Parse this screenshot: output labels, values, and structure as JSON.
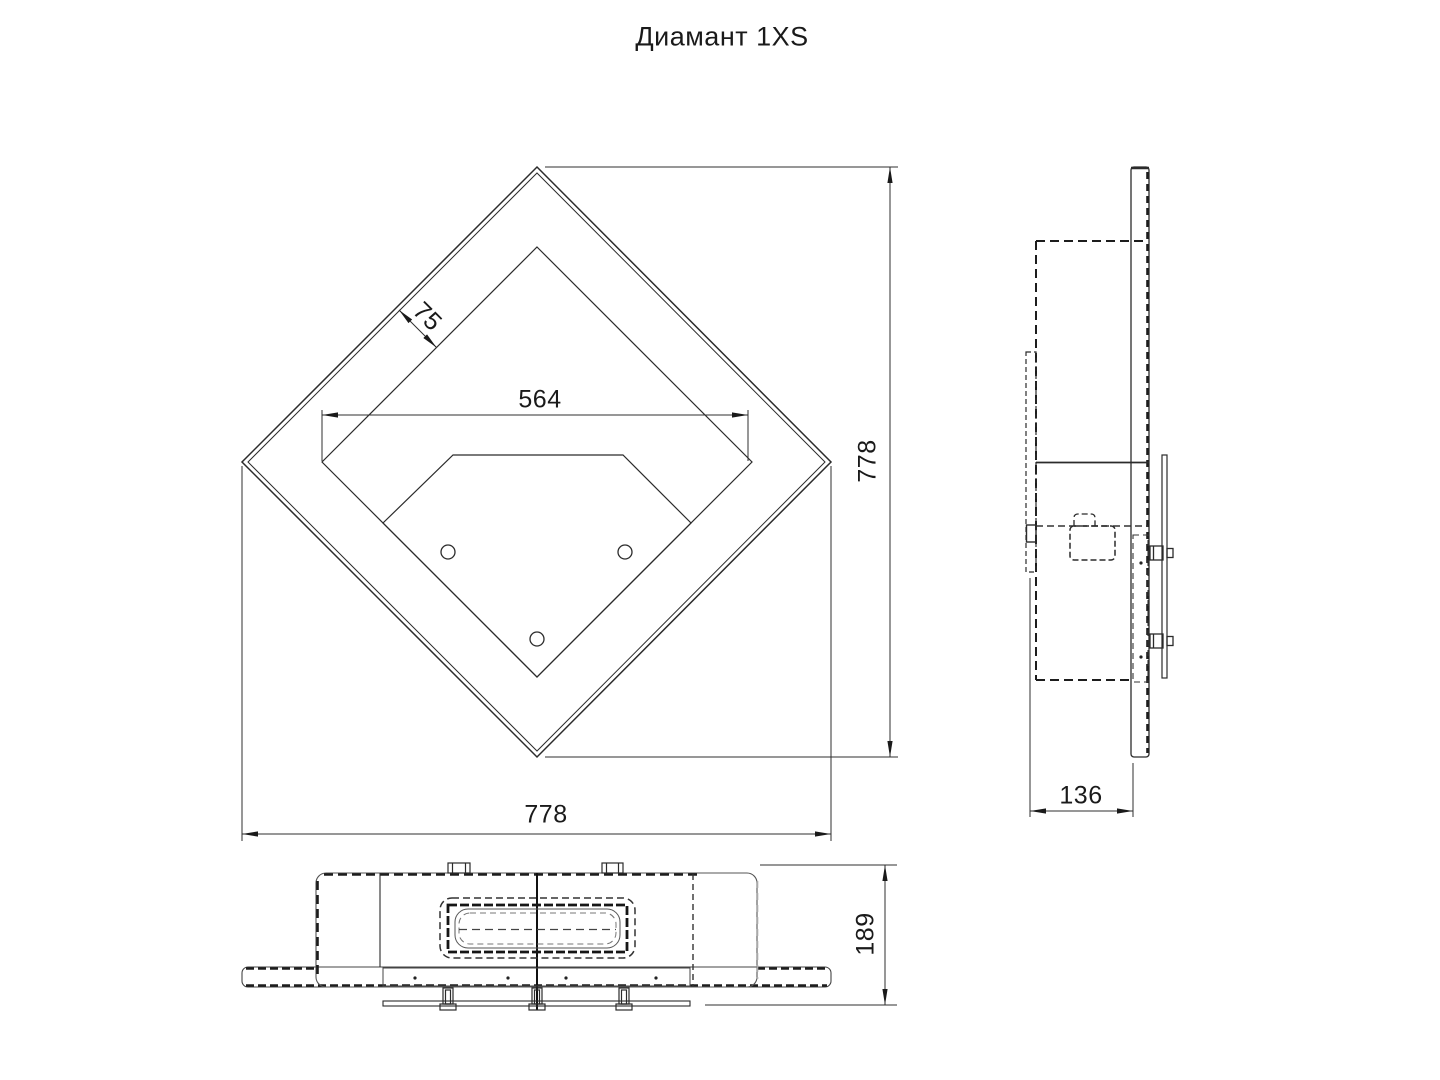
{
  "title": "Диамант 1XS",
  "colors": {
    "ink": "#2b2b2b",
    "background": "#ffffff"
  },
  "dimensions": {
    "diamond_width": "778",
    "diamond_height": "778",
    "frame_offset": "75",
    "opening_width": "564",
    "side_depth": "136",
    "bottom_depth": "189"
  }
}
